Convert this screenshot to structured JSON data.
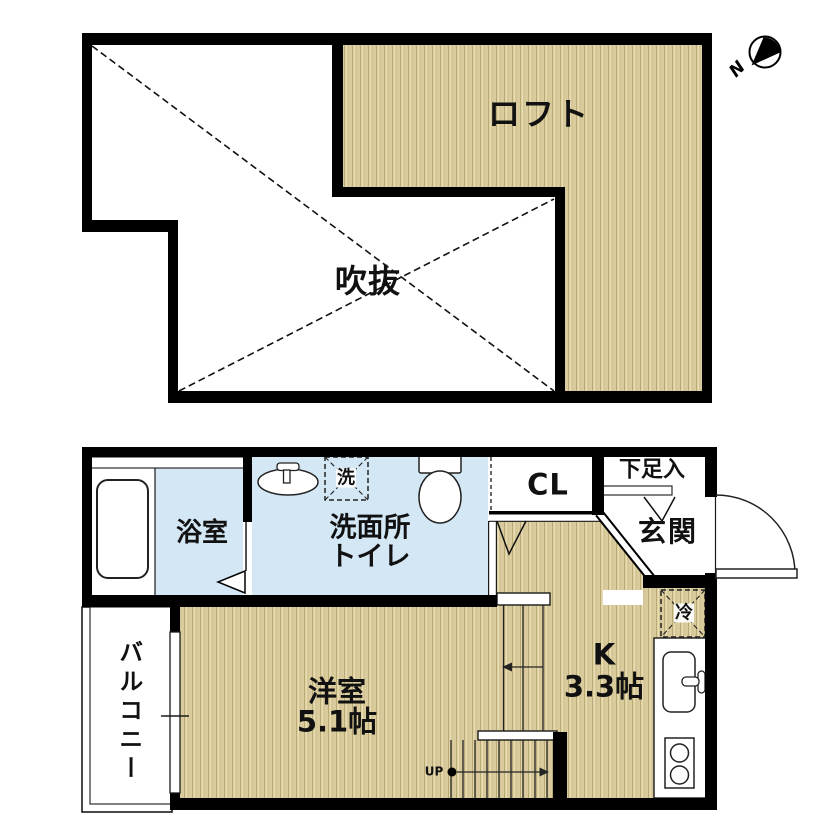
{
  "colors": {
    "wall": "#000000",
    "water_blue": "#d3e7f5",
    "hatch_light": "#e9dfb6",
    "hatch_mid": "#d9cb9c",
    "hatch_dark": "#b9a973",
    "line": "#1a1a1a"
  },
  "loft_plan": {
    "loft_label": "ロフト",
    "void_label": "吹抜",
    "compass_n": "N"
  },
  "main_plan": {
    "bath_label": "浴室",
    "washroom_line1": "洗面所",
    "washroom_line2": "トイレ",
    "washer_label": "洗",
    "closet_label": "CL",
    "shoe_label": "下足入",
    "entrance_label": "玄関",
    "fridge_label": "冷",
    "room_label": "洋室",
    "room_size": "5.1帖",
    "kitchen_label": "K",
    "kitchen_size": "3.3帖",
    "balcony_label": "バルコニー",
    "stairs_up_label": "UP"
  }
}
